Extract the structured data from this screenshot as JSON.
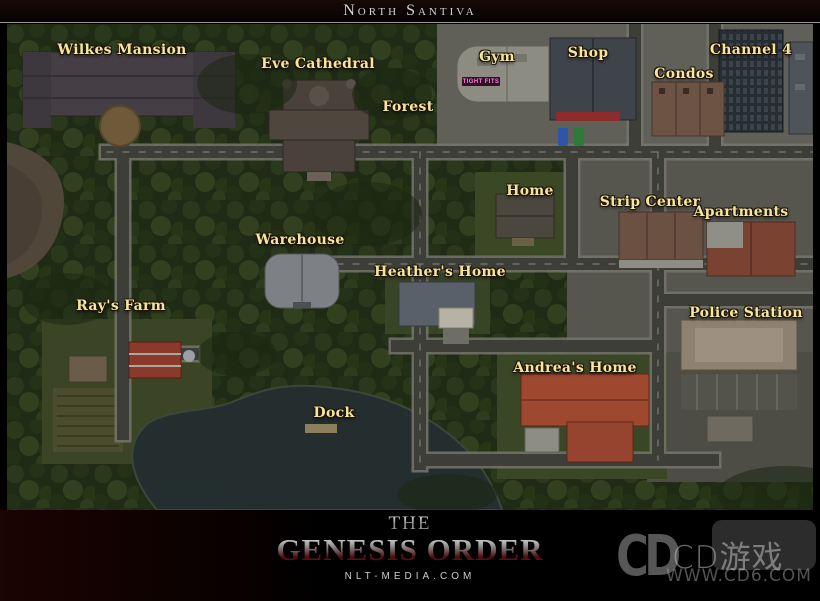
{
  "header": {
    "title": "North Santiva"
  },
  "map": {
    "labels": [
      {
        "id": "wilkes-mansion",
        "text": "Wilkes Mansion"
      },
      {
        "id": "eve-cathedral",
        "text": "Eve Cathedral"
      },
      {
        "id": "forest",
        "text": "Forest"
      },
      {
        "id": "gym",
        "text": "Gym"
      },
      {
        "id": "shop",
        "text": "Shop"
      },
      {
        "id": "channel-4",
        "text": "Channel 4"
      },
      {
        "id": "condos",
        "text": "Condos"
      },
      {
        "id": "home",
        "text": "Home"
      },
      {
        "id": "strip-center",
        "text": "Strip Center"
      },
      {
        "id": "apartments",
        "text": "Apartments"
      },
      {
        "id": "warehouse",
        "text": "Warehouse"
      },
      {
        "id": "heathers-home",
        "text": "Heather's Home"
      },
      {
        "id": "rays-farm",
        "text": "Ray's Farm"
      },
      {
        "id": "police-station",
        "text": "Police Station"
      },
      {
        "id": "andreas-home",
        "text": "Andrea's Home"
      },
      {
        "id": "dock",
        "text": "Dock"
      }
    ],
    "signs": {
      "gym_sign": "TIGHT FITS"
    }
  },
  "footer": {
    "logo_top": "The",
    "logo_main": "Genesis Order",
    "site": "NLT-MEDIA.COM"
  },
  "watermark": {
    "logo_glyph": "CD",
    "brand": "CD游戏",
    "url": "WWW.CD6.COM"
  },
  "colors": {
    "label_gold": "#f6e59c",
    "title_gray": "#d4d4d4",
    "forest_green": "#26331a",
    "road_asphalt": "#3e3e39",
    "water": "#242e2f",
    "andrea_roof": "#9e4830",
    "barn_red": "#8a392a",
    "awning_red": "#8e2c2c",
    "gym_sign_pink": "#ff7fd8",
    "logo_red": "#8a1717"
  }
}
